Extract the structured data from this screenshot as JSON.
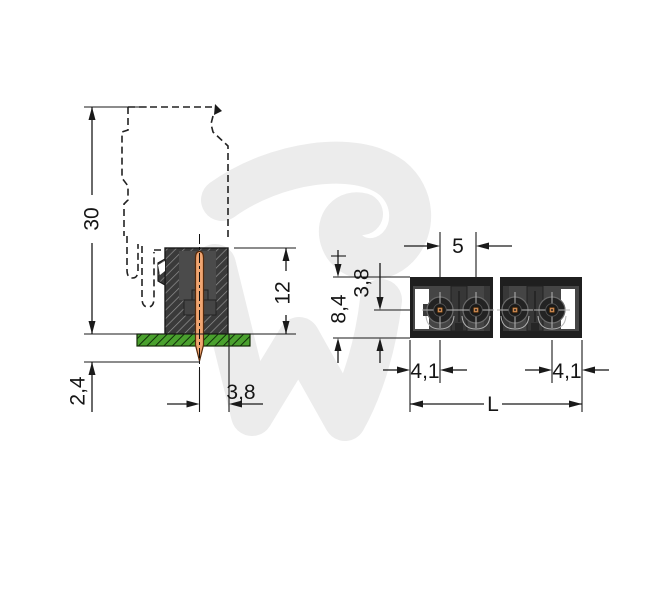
{
  "drawing": {
    "type": "connector-technical-drawing",
    "watermark_icon": "wago-logo-watermark",
    "views": {
      "side_section": {
        "title": "side cross-section view",
        "labels": {
          "overall_height": "30",
          "housing_height": "12",
          "pin_tail_length": "2,4",
          "pin_to_edge": "3,8"
        }
      },
      "front_view": {
        "title": "front view",
        "labels": {
          "pin_pitch": "5",
          "top_to_pin_center": "3,8",
          "body_height": "8,4",
          "edge_to_pin_left": "4,1",
          "edge_to_pin_right": "4,1",
          "total_length": "L"
        }
      }
    },
    "colors": {
      "line": "#1a1a1a",
      "housing-dark": "#3a3a3a",
      "housing-inner": "#4b4b4b",
      "front-body": "#454545",
      "pin-copper": "#f0a571",
      "pcb-green": "#4aa12e",
      "watermark-gray": "#ececec",
      "contact-square": "#c7854f"
    }
  }
}
